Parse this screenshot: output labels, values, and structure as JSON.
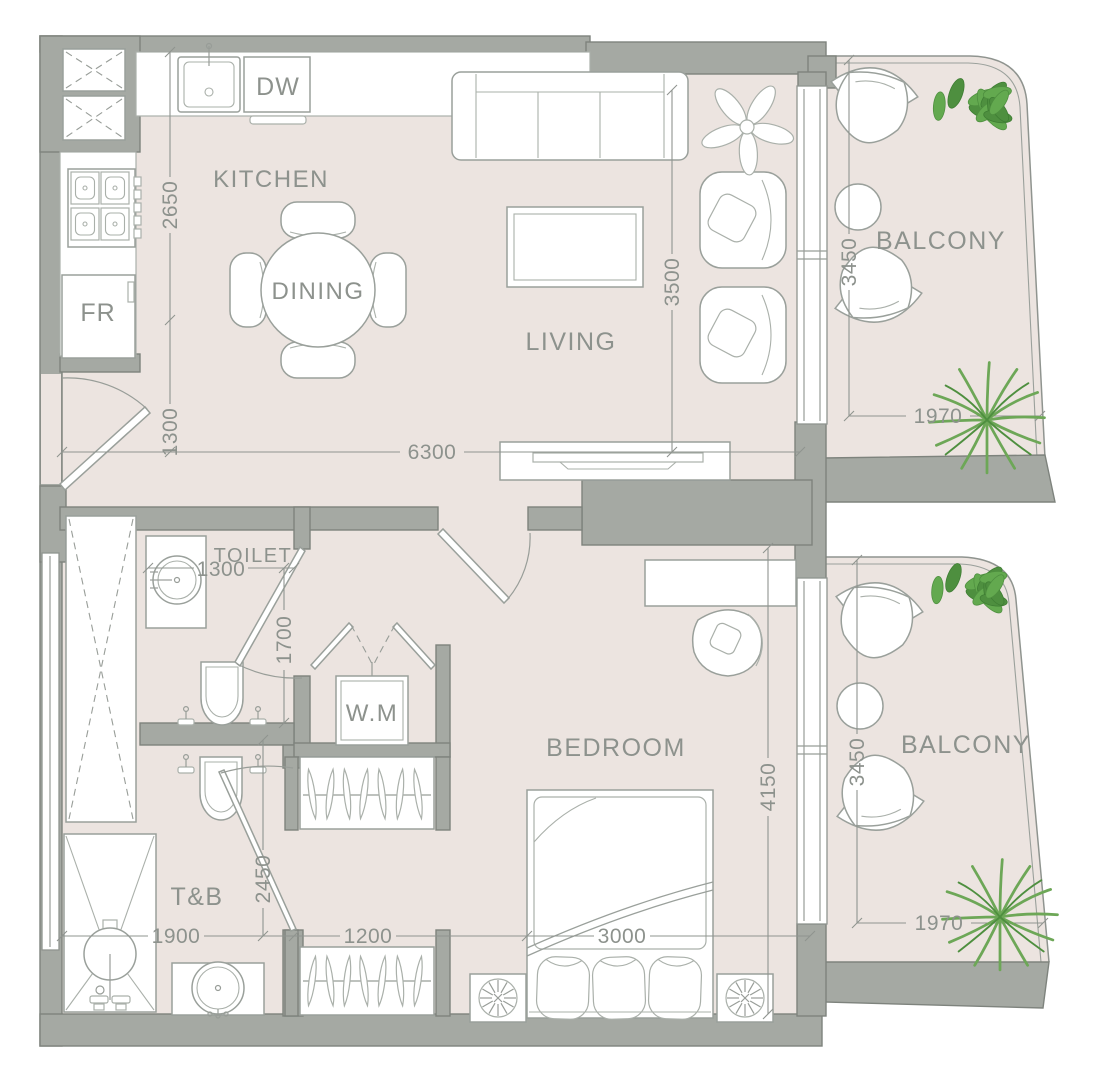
{
  "title": "apartment-floor-plan",
  "rooms": {
    "kitchen": "KITCHEN",
    "dining": "DINING",
    "living": "LIVING",
    "toilet": "TOILET",
    "washing_machine": "W.M",
    "bedroom": "BEDROOM",
    "bath": "T&B",
    "balcony_upper": "BALCONY",
    "balcony_lower": "BALCONY"
  },
  "appliances": {
    "dishwasher": "DW",
    "fridge": "FR"
  },
  "dimensions": {
    "kitchen_depth": "2650",
    "entry_width": "1300",
    "living_width": "3500",
    "overall_width": "6300",
    "toilet_width": "1300",
    "toilet_depth": "1700",
    "bath_door": "2450",
    "bath_width": "1900",
    "wardrobe_width": "1200",
    "bed_width": "3000",
    "bedroom_depth": "4150",
    "balcony_upper_depth": "3450",
    "balcony_upper_width": "1970",
    "balcony_lower_depth": "3450",
    "balcony_lower_width": "1970"
  },
  "colors": {
    "floor": "#ece4e0",
    "wall": "#a5a9a3",
    "wall_border": "#7e837d",
    "line_gray": "#9aa09b",
    "text_gray": "#8d928d",
    "plant_green": "#63a94f"
  }
}
